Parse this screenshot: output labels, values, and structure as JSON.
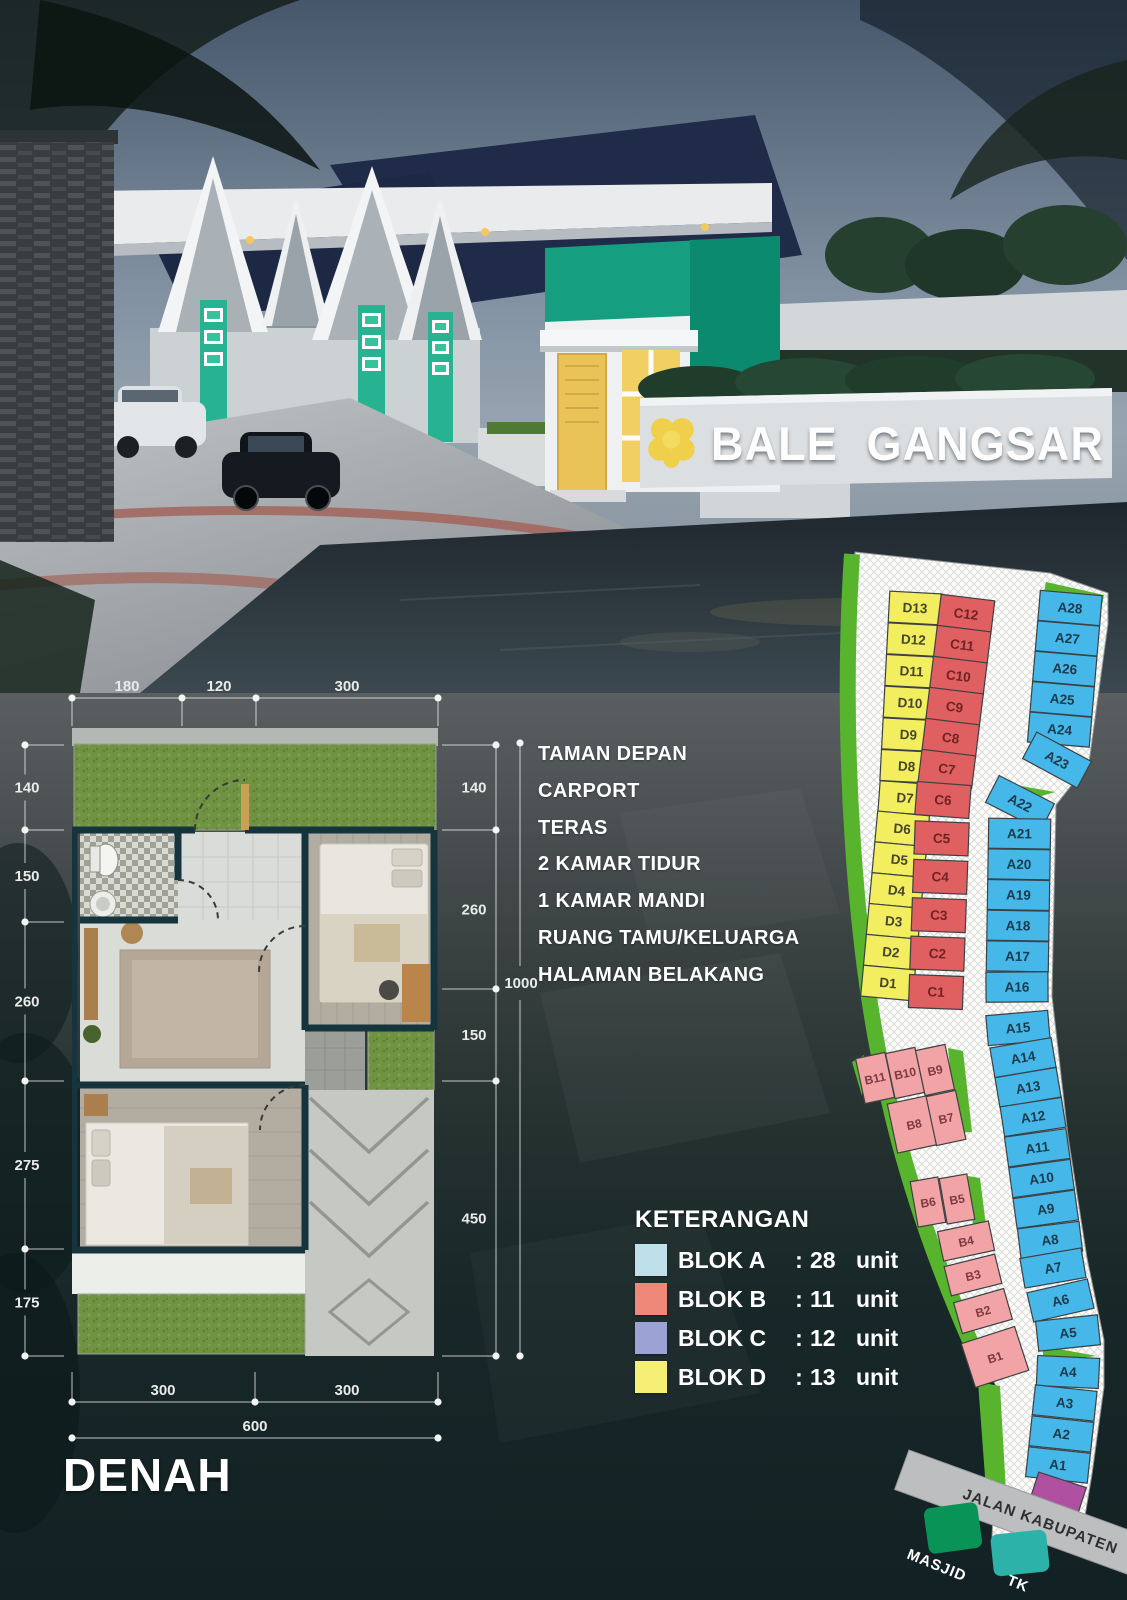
{
  "hero": {
    "brand": "BALE GANGSAR"
  },
  "features": {
    "items": [
      "TAMAN DEPAN",
      "CARPORT",
      "TERAS",
      "2 KAMAR TIDUR",
      "1 KAMAR MANDI",
      "RUANG TAMU/KELUARGA",
      "HALAMAN BELAKANG"
    ]
  },
  "floorplan": {
    "title": "DENAH",
    "dims_top": [
      "180",
      "120",
      "300"
    ],
    "dims_left": [
      "140",
      "150",
      "260",
      "275",
      "175"
    ],
    "dims_right": [
      "140",
      "260",
      "150",
      "450"
    ],
    "dims_right_total": "1000",
    "dims_bottom": [
      "300",
      "300"
    ],
    "dims_bottom_total": "600"
  },
  "legend": {
    "title": "KETERANGAN",
    "items": [
      {
        "label": "BLOK A",
        "separator": ":",
        "count": "28",
        "unit": "unit",
        "swatch": "#bfe0ea"
      },
      {
        "label": "BLOK B",
        "separator": ":",
        "count": "11",
        "unit": "unit",
        "swatch": "#ef8878"
      },
      {
        "label": "BLOK C",
        "separator": ":",
        "count": "12",
        "unit": "unit",
        "swatch": "#9aa3d4"
      },
      {
        "label": "BLOK D",
        "separator": ":",
        "count": "13",
        "unit": "unit",
        "swatch": "#f5ef76"
      }
    ]
  },
  "siteplan": {
    "accent_green": "#58b42d",
    "road_fill": "#b050a0",
    "road_label": "JALAN KABUPATEN",
    "blocks": {
      "D": {
        "color": "#f2ee5f",
        "text": "#46462e",
        "units": [
          "D13",
          "D12",
          "D11",
          "D10",
          "D9",
          "D8",
          "D7",
          "D6",
          "D5",
          "D4",
          "D3",
          "D2",
          "D1"
        ]
      },
      "C": {
        "color": "#e05f60",
        "text": "#6e2424",
        "units": [
          "C12",
          "C11",
          "C10",
          "C9",
          "C8",
          "C7",
          "C6",
          "C5",
          "C4",
          "C3",
          "C2",
          "C1"
        ]
      },
      "A": {
        "color": "#45b7e9",
        "text": "#1d3a4a",
        "units": [
          "A28",
          "A27",
          "A26",
          "A25",
          "A24",
          "A23",
          "A22",
          "A21",
          "A20",
          "A19",
          "A18",
          "A17",
          "A16",
          "A15",
          "A14",
          "A13",
          "A12",
          "A11",
          "A10",
          "A9",
          "A8",
          "A7",
          "A6",
          "A5",
          "A4",
          "A3",
          "A2",
          "A1"
        ]
      },
      "B": {
        "color": "#f2a3a6",
        "text": "#7c3a40",
        "units": [
          "B11",
          "B10",
          "B9",
          "B8",
          "B7",
          "B6",
          "B5",
          "B4",
          "B3",
          "B2",
          "B1"
        ]
      }
    },
    "pois": [
      {
        "label": "MASJID",
        "color": "#0a9356"
      },
      {
        "label": "TK",
        "color": "#2cb2a8"
      }
    ]
  }
}
